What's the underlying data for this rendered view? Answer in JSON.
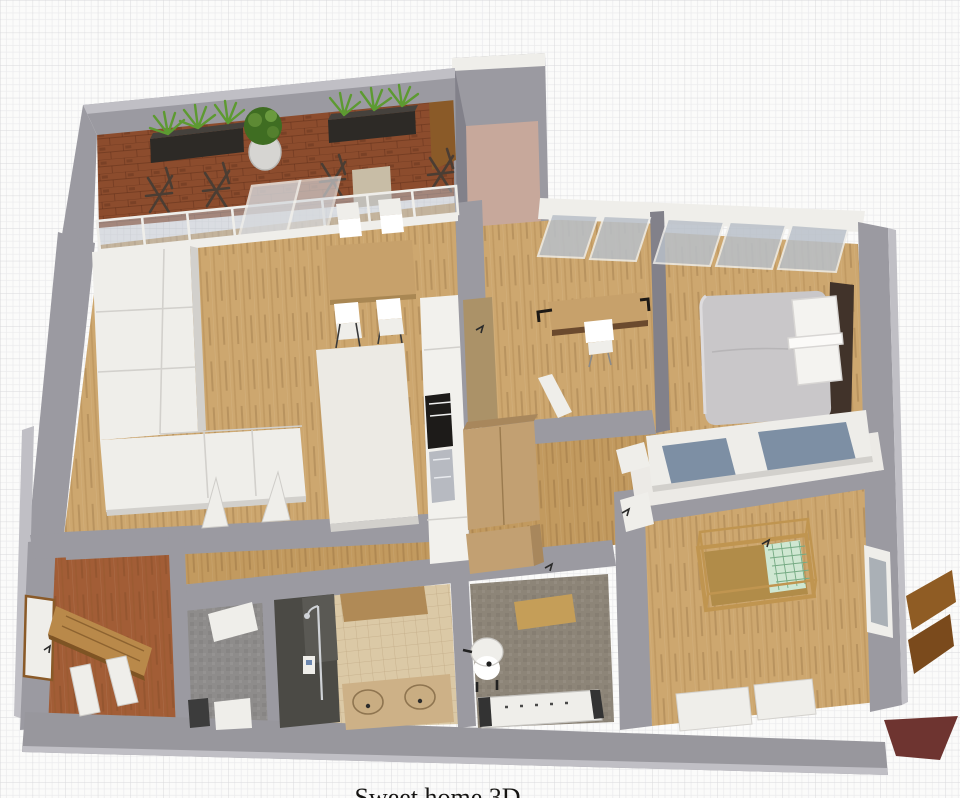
{
  "caption": {
    "text": "Sweet home 3D"
  },
  "scene": {
    "type": "3d-floor-plan-render",
    "background": "grid-paper",
    "rooms": [
      "balcony-terrace",
      "living-dining-room",
      "kitchen",
      "office-room",
      "master-bedroom",
      "nursery",
      "hallway",
      "entry-hall",
      "laundry-room",
      "bathroom",
      "wc-room",
      "upper-niche"
    ],
    "furniture": [
      "planter-box",
      "round-plant-pot",
      "folding-chair",
      "glass-sliding-wall",
      "l-shaped-sofa",
      "dining-table",
      "dining-chair",
      "kitchen-island",
      "kitchen-counter",
      "oven",
      "kitchen-sink",
      "desk",
      "desk-chair",
      "double-bed",
      "pillows",
      "sliding-wardrobe",
      "baby-crib",
      "dresser",
      "hall-closet",
      "front-door",
      "interior-door",
      "shower-cabin",
      "double-sink-vanity",
      "toilet",
      "radiator-bench",
      "washing-machine",
      "window-shutter",
      "wall-window"
    ]
  },
  "palette": {
    "paper": "#fbfbfa",
    "gridFine": "#ebebed",
    "gridMajor": "#d9d9dc",
    "wall": "#9b9aa1",
    "wallLight": "#c0bfc5",
    "wallDark": "#82818a",
    "wallWhiteTop": "#eceae6",
    "bottomWall": "#98979d",
    "wood": "#cda76f",
    "corridorWood": "#c29a5f",
    "entryWood": "#a25d36",
    "brick": "#8c4c2d",
    "nichePink": "#c7a89b",
    "tileBeige": "#dbc9a6",
    "grayFloor": "#8e8c8b",
    "wcFloor": "#8d8578",
    "showerDark": "#4b4a45",
    "white": "#ffffff",
    "offWhite": "#efeeea",
    "softShadow": "#d2d0cc",
    "counterWhite": "#f2f1ed",
    "ovenBlack": "#1d1b19",
    "sinkGray": "#b7bac1",
    "tableWood": "#c7a16b",
    "islandWhite": "#eceae4",
    "duvet": "#c9c7c9",
    "headboard": "#41332a",
    "pillow": "#f4f3f0",
    "blueDoor": "#7d8fa4",
    "wardrobeWhite": "#eeede9",
    "cribWood": "#c09550",
    "cribMattress": "#b18c49",
    "cribPad": "#cfe7d2",
    "cribPadLine": "#76ab84",
    "planter": "#2d2a26",
    "plantGreen": "#5d9a31",
    "plantDark": "#3f6d22",
    "potGray": "#d6d5d2",
    "glassBlue": "#b9c0c9",
    "glassLight": "#d6d9dd",
    "chairBrown": "#4b3d33",
    "doorBrown": "#8a5a28",
    "doorTan": "#b9894a",
    "shutter": "#8f5c24",
    "shutter2": "#7a4a1c",
    "maroon": "#6e3430",
    "closet": "#c2a072",
    "closetDark": "#a8875c",
    "cabinetTan": "#ab9268",
    "bathCab": "#b08a56",
    "vanity": "#cdb187",
    "sinkTan": "#c9ad82",
    "captionText": "#151412"
  }
}
